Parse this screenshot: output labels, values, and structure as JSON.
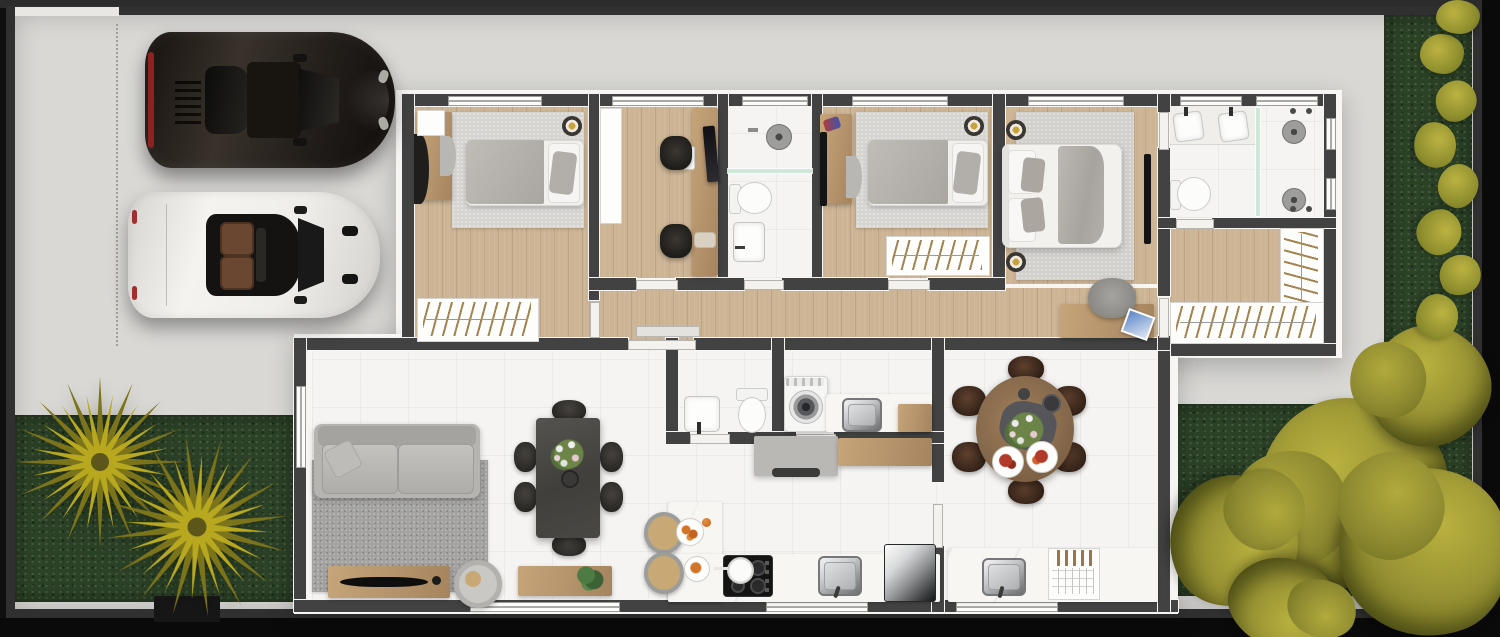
{
  "scene": {
    "title": "house-floor-plan-top-view",
    "style": "3d-rendered-top-down-floor-plan",
    "visible_text": []
  },
  "palette": {
    "outer_background": "#0f0f0f",
    "fence": "#303030",
    "concrete": "#d9d8d5",
    "house_wall": "#424242",
    "house_trim": "#f7f6f3",
    "wood_floor": "#ccb494",
    "tile_floor": "#f5f4f2",
    "grass": "#2c4227",
    "palm_foliage": "#b3a520",
    "tree_foliage": "#a49c38",
    "glass_partition": "#cde8d8",
    "rug_living": "#a3a2a0",
    "rug_bedroom": "#d7d5d2",
    "sofa": "#b5b4b1",
    "dining_table_dark": "#4c4a47",
    "wood_furniture": "#bb9d75",
    "car_dark": "#2a2420",
    "car_white": "#efeeea",
    "tail_light_red": "#8e2222"
  },
  "driveway": {
    "cars": [
      {
        "name": "dark-sports-car",
        "color": "#2a2420",
        "facing": "right"
      },
      {
        "name": "white-convertible",
        "color": "#efeeea",
        "facing": "right",
        "detail": "open-top-brown-seats"
      }
    ],
    "parking_marking": "dotted-line"
  },
  "gardens": {
    "front_lawn": {
      "trees": [
        "palm",
        "palm"
      ]
    },
    "side_strip": {
      "shrub_count": 7
    },
    "back_garden": {
      "tree_count": 4
    }
  },
  "rooms": [
    {
      "name": "bedroom-1",
      "floor": "wood",
      "furniture": [
        "single-bed",
        "rug",
        "desk",
        "chair",
        "nightstand",
        "ceiling-lamp",
        "wardrobe"
      ]
    },
    {
      "name": "home-office",
      "floor": "wood",
      "furniture": [
        "desk",
        "monitor",
        "office-chair",
        "office-chair",
        "white-cabinet"
      ]
    },
    {
      "name": "bathroom",
      "floor": "tile",
      "furniture": [
        "shower-head",
        "glass-partition",
        "toilet",
        "washbasin"
      ]
    },
    {
      "name": "bedroom-2",
      "floor": "wood",
      "furniture": [
        "single-bed",
        "rug",
        "desk",
        "wall-tv",
        "ceiling-lamp",
        "wardrobe"
      ]
    },
    {
      "name": "master-bedroom",
      "floor": "wood",
      "furniture": [
        "double-bed",
        "rug",
        "bedside-lamp",
        "bedside-lamp",
        "wall-tv",
        "desk",
        "chair",
        "blue-folder"
      ]
    },
    {
      "name": "master-bathroom",
      "floor": "tile",
      "furniture": [
        "double-vanity",
        "toilet",
        "glass-partition",
        "shower-head",
        "shower-head"
      ]
    },
    {
      "name": "walk-in-closet",
      "floor": "wood",
      "furniture": [
        "wardrobe-bottom",
        "wardrobe-side"
      ]
    },
    {
      "name": "hallway",
      "floor": "wood",
      "furniture": [
        "console-shelf",
        "sliding-door"
      ]
    },
    {
      "name": "living-room",
      "floor": "tile",
      "furniture": [
        "sofa",
        "rug",
        "tv-console",
        "tv",
        "side-table",
        "sideboard",
        "plant"
      ]
    },
    {
      "name": "dining-area",
      "floor": "tile",
      "furniture": [
        "rectangular-table",
        "six-chairs",
        "flower-vase"
      ]
    },
    {
      "name": "wc",
      "floor": "tile",
      "furniture": [
        "washbasin",
        "toilet"
      ]
    },
    {
      "name": "laundry",
      "floor": "tile",
      "furniture": [
        "washing-machine",
        "marble-counter",
        "steel-sink",
        "wood-counter"
      ]
    },
    {
      "name": "kitchen",
      "floor": "tile",
      "furniture": [
        "grey-island",
        "vent",
        "breakfast-bar",
        "stool",
        "stool",
        "plates-of-food",
        "cooktop",
        "pot",
        "steel-sink",
        "fridge"
      ]
    },
    {
      "name": "breakfast-nook",
      "floor": "tile",
      "furniture": [
        "round-wood-table",
        "six-brown-chairs",
        "centerpiece-flowers",
        "two-plates",
        "cups"
      ]
    },
    {
      "name": "utility-counter",
      "floor": "tile",
      "furniture": [
        "counter",
        "steel-sink",
        "dish-rack"
      ]
    }
  ]
}
